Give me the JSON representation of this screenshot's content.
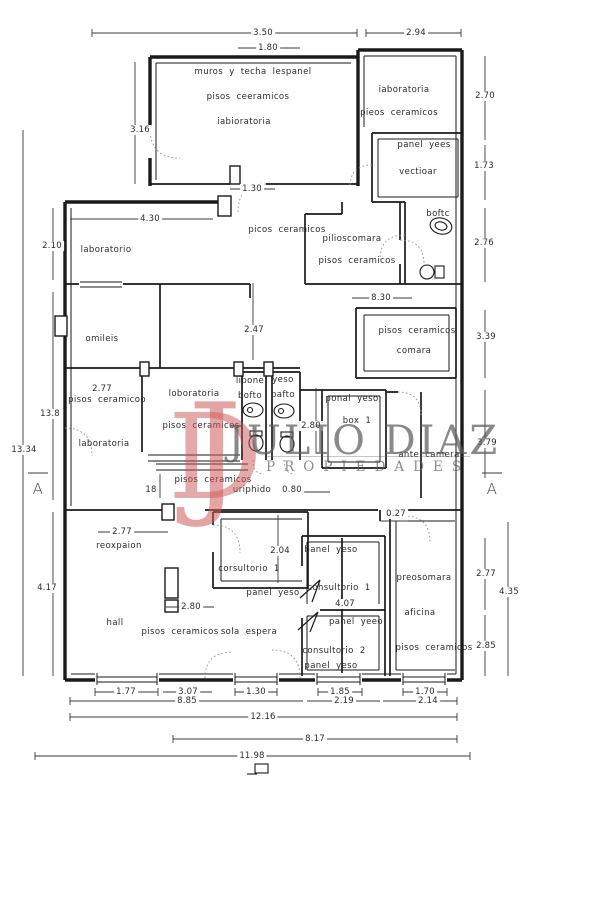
{
  "watermark": {
    "monogram_j": "J",
    "monogram_d": "D",
    "name": "JULIO DIAZ",
    "tagline": "PROPIEDADES"
  },
  "plan": {
    "markers": {
      "left": "A",
      "right": "A"
    },
    "rooms": {
      "lab_top_left": {
        "l1": "muros y techa lespanel",
        "l2": "pisos ceeramicos",
        "l3": "iabioratoria"
      },
      "lab_top_right": {
        "l1": "iaboratoria",
        "l2": "pieos ceramicos"
      },
      "vestibule": {
        "l1": "panel yees",
        "l2": "vectioar"
      },
      "bath_top": {
        "l1": "boftc"
      },
      "lab_mid_left": {
        "l1": "laboratorio"
      },
      "ceramics_hall": {
        "l1": "picos ceramicos"
      },
      "pilioscomara": {
        "l1": "pilioscomara",
        "l2": "pisos ceramicos"
      },
      "camara": {
        "l1": "pisos ceramicos",
        "l2": "comara"
      },
      "omileis": {
        "l1": "omileis"
      },
      "lab_left": {
        "l1": "pisos ceramicoo",
        "l2": "laboratoria"
      },
      "lab_center": {
        "l1": "loboratoria",
        "l2": "pisos ceramicos"
      },
      "corridor": {
        "l1": "pisos ceramicos",
        "l2": "uriphido"
      },
      "wc_left": {
        "l1": "lipone",
        "l2": "bofto"
      },
      "wc_right": {
        "l1": "yeso",
        "l2": "pafto"
      },
      "box1": {
        "l1": "ponal yeso",
        "l2": "box  1"
      },
      "ante_camera": {
        "l1": "ante camera"
      },
      "reception": {
        "l1": "reoxpaion"
      },
      "hall": {
        "l1": "hall",
        "l2": "pisos ceramicos",
        "l3": "sola espera"
      },
      "consult1_center": {
        "l1": "corsultorio 1",
        "l2": "panel yeso"
      },
      "consult1_right": {
        "l1": "banel yeso",
        "l2": "cohsultorio 1",
        "l3": "panel yeeo"
      },
      "consult2": {
        "l1": "consultorio 2",
        "l2": "panel yeso"
      },
      "office": {
        "l1": "preosomara",
        "l2": "aficina",
        "l3": "pisos ceramicos"
      }
    },
    "dims": {
      "v350": "3.50",
      "v294": "2.94",
      "v180": "1.80",
      "v316": "3.16",
      "v270": "2.70",
      "v173": "1.73",
      "v276": "2.76",
      "v210": "2.10",
      "v430": "4.30",
      "v130_top": "1.30",
      "v830": "8.30",
      "v247": "2.47",
      "v339": "3.39",
      "v277_left": "2.77",
      "v138": "13.8",
      "v1334": "13.34",
      "v280_bath": "2.80",
      "v379": "3.79",
      "v18": "18",
      "v080": "0.80",
      "v277_recep": "2.77",
      "v417": "4.17",
      "v204": "2.04",
      "v280_hall": "2.80",
      "v027": "0.27",
      "v407": "4.07",
      "v277_right": "2.77",
      "v435": "4.35",
      "v285": "2.85",
      "v177": "1.77",
      "v307": "3.07",
      "v130_bottom": "1.30",
      "v185": "1.85",
      "v170": "1.70",
      "v885": "8.85",
      "v219": "2.19",
      "v214": "2.14",
      "v1216": "12.16",
      "v817": "8.17",
      "v1198": "11.98"
    }
  }
}
